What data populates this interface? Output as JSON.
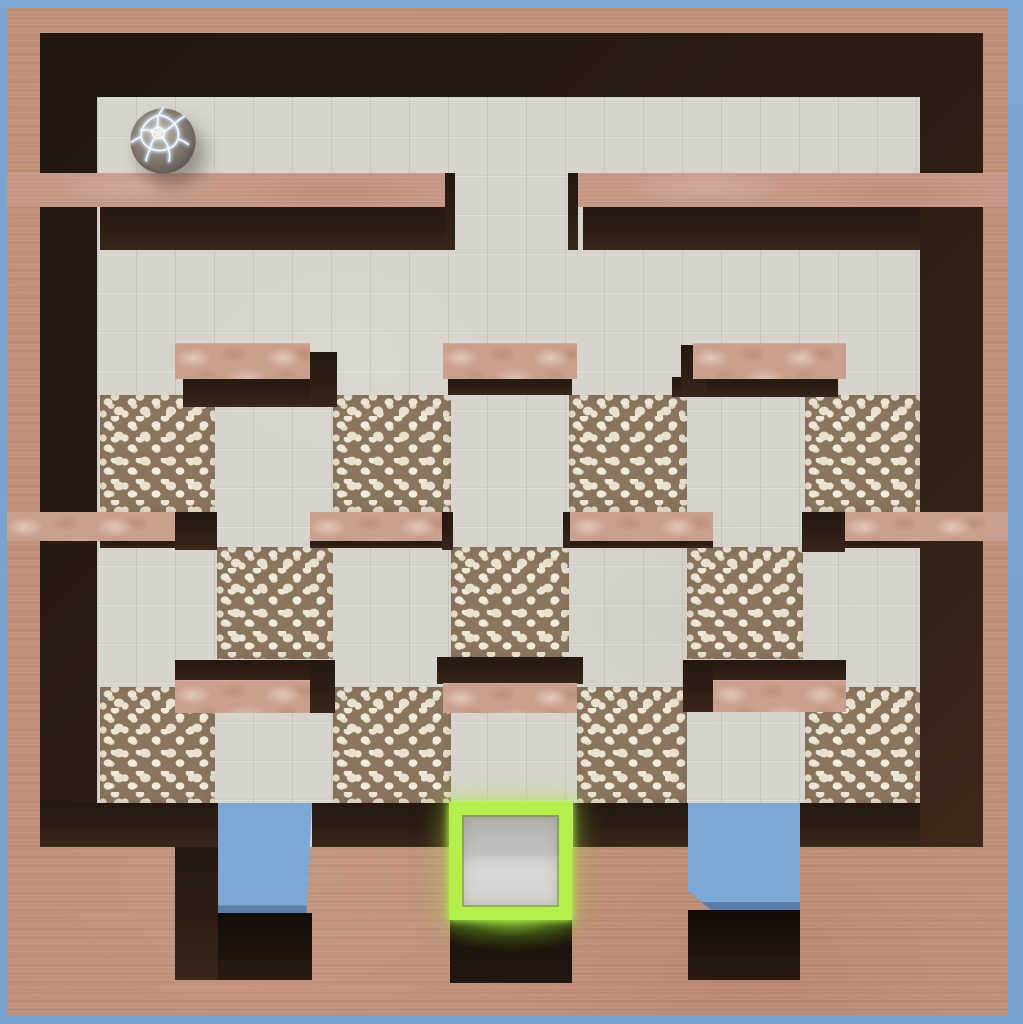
{
  "title": "marble-maze-level",
  "colors": {
    "sky": "#7ba8d3",
    "terracotta": "#c09078",
    "wall_top": "#c69685",
    "dark_wall": "#2a1c14",
    "floor_tile": "#d7d4cd",
    "pebble_ground": "#8a765f",
    "pebble_stone": "#f2ecdd",
    "marble_pink": "#cb9f8d",
    "goal_green": "#b4ef4b",
    "pit_blue": "#7ba8d4",
    "ball_seam": "#eaf3ff"
  },
  "game": {
    "ball": {
      "cx": 163,
      "cy": 141,
      "r": 34
    },
    "goal": {
      "x": 449,
      "y": 802,
      "w": 123,
      "h": 118
    },
    "pits": [
      {
        "x": 218,
        "y": 803,
        "w": 94,
        "h": 114
      },
      {
        "x": 688,
        "y": 803,
        "w": 112,
        "h": 110
      }
    ]
  },
  "scene": {
    "width": 1023,
    "height": 1024,
    "boxes": [
      {
        "name": "sky-background",
        "cls": "sky",
        "x": 0,
        "y": 0,
        "w": 1023,
        "h": 1024
      },
      {
        "name": "outer-wall-frame",
        "cls": "terr",
        "x": 7,
        "y": 8,
        "w": 1001,
        "h": 1007
      },
      {
        "name": "inner-wall-shadow",
        "cls": "dark",
        "x": 40,
        "y": 33,
        "w": 943,
        "h": 948
      },
      {
        "name": "tiled-floor",
        "cls": "tile",
        "x": 97,
        "y": 97,
        "w": 823,
        "h": 750
      },
      {
        "name": "pebble-patch",
        "cls": "pebble",
        "x": 100,
        "y": 395,
        "w": 115,
        "h": 117
      },
      {
        "name": "pebble-patch",
        "cls": "pebble",
        "x": 333,
        "y": 395,
        "w": 118,
        "h": 117
      },
      {
        "name": "pebble-patch",
        "cls": "pebble",
        "x": 569,
        "y": 395,
        "w": 118,
        "h": 117
      },
      {
        "name": "pebble-patch",
        "cls": "pebble",
        "x": 805,
        "y": 395,
        "w": 115,
        "h": 117
      },
      {
        "name": "pebble-patch",
        "cls": "pebble",
        "x": 217,
        "y": 547,
        "w": 116,
        "h": 112
      },
      {
        "name": "pebble-patch",
        "cls": "pebble",
        "x": 451,
        "y": 547,
        "w": 118,
        "h": 112
      },
      {
        "name": "pebble-patch",
        "cls": "pebble",
        "x": 687,
        "y": 547,
        "w": 116,
        "h": 112
      },
      {
        "name": "pebble-patch",
        "cls": "pebble",
        "x": 100,
        "y": 687,
        "w": 115,
        "h": 116
      },
      {
        "name": "pebble-patch",
        "cls": "pebble",
        "x": 333,
        "y": 687,
        "w": 118,
        "h": 116
      },
      {
        "name": "pebble-patch",
        "cls": "pebble",
        "x": 577,
        "y": 687,
        "w": 110,
        "h": 116
      },
      {
        "name": "pebble-patch",
        "cls": "pebble",
        "x": 805,
        "y": 687,
        "w": 115,
        "h": 116
      },
      {
        "name": "wall-row1-left-face",
        "cls": "darkface",
        "x": 100,
        "y": 205,
        "w": 352,
        "h": 45
      },
      {
        "name": "wall-row1-right-face",
        "cls": "darkface",
        "x": 583,
        "y": 205,
        "w": 337,
        "h": 45
      },
      {
        "name": "wall-row1-left-endcap",
        "cls": "darkface",
        "x": 445,
        "y": 173,
        "w": 10,
        "h": 77
      },
      {
        "name": "wall-row1-right-endcap",
        "cls": "darkface",
        "x": 568,
        "y": 173,
        "w": 10,
        "h": 77
      },
      {
        "name": "wall-row1-left-top",
        "cls": "walltop",
        "x": 7,
        "y": 173,
        "w": 438,
        "h": 34
      },
      {
        "name": "wall-row1-right-top",
        "cls": "walltop",
        "x": 578,
        "y": 173,
        "w": 430,
        "h": 34
      },
      {
        "name": "midwall-a-face",
        "cls": "darkface",
        "x": 100,
        "y": 539,
        "w": 75,
        "h": 9
      },
      {
        "name": "midwall-b-face",
        "cls": "darkface",
        "x": 310,
        "y": 539,
        "w": 132,
        "h": 9
      },
      {
        "name": "midwall-c-face",
        "cls": "darkface",
        "x": 570,
        "y": 539,
        "w": 143,
        "h": 9
      },
      {
        "name": "midwall-d-face",
        "cls": "darkface",
        "x": 845,
        "y": 539,
        "w": 75,
        "h": 9
      },
      {
        "name": "midwall-a-endcap",
        "cls": "darkface",
        "x": 175,
        "y": 512,
        "w": 42,
        "h": 38
      },
      {
        "name": "midwall-b-endcap",
        "cls": "darkface",
        "x": 442,
        "y": 512,
        "w": 11,
        "h": 38
      },
      {
        "name": "midwall-c-endcap",
        "cls": "darkface",
        "x": 563,
        "y": 512,
        "w": 7,
        "h": 36
      },
      {
        "name": "midwall-d-endcap",
        "cls": "darkface",
        "x": 802,
        "y": 512,
        "w": 43,
        "h": 40
      },
      {
        "name": "midwall-a-top",
        "cls": "midwall",
        "x": 7,
        "y": 512,
        "w": 168,
        "h": 29
      },
      {
        "name": "midwall-b-top",
        "cls": "midwall",
        "x": 310,
        "y": 512,
        "w": 132,
        "h": 29
      },
      {
        "name": "midwall-c-top",
        "cls": "midwall",
        "x": 570,
        "y": 512,
        "w": 143,
        "h": 29
      },
      {
        "name": "midwall-d-top",
        "cls": "midwall",
        "x": 845,
        "y": 512,
        "w": 163,
        "h": 29
      },
      {
        "name": "block-upper-left-face-s",
        "cls": "darkface",
        "x": 183,
        "y": 377,
        "w": 152,
        "h": 30
      },
      {
        "name": "block-upper-left-face-e",
        "cls": "darkface",
        "x": 310,
        "y": 352,
        "w": 27,
        "h": 55
      },
      {
        "name": "block-upper-left-top",
        "cls": "blocktop",
        "x": 175,
        "y": 343,
        "w": 135,
        "h": 36
      },
      {
        "name": "block-upper-center-face-s",
        "cls": "darkface",
        "x": 448,
        "y": 377,
        "w": 124,
        "h": 18
      },
      {
        "name": "block-upper-center-top",
        "cls": "blocktop",
        "x": 443,
        "y": 343,
        "w": 134,
        "h": 36
      },
      {
        "name": "block-upper-right-face-s",
        "cls": "darkface",
        "x": 672,
        "y": 377,
        "w": 166,
        "h": 20
      },
      {
        "name": "block-upper-right-face-w",
        "cls": "darkface",
        "x": 681,
        "y": 345,
        "w": 26,
        "h": 52
      },
      {
        "name": "block-upper-right-top",
        "cls": "blocktop",
        "x": 693,
        "y": 343,
        "w": 153,
        "h": 36
      },
      {
        "name": "block-lower-left-face-n",
        "cls": "darkface",
        "x": 175,
        "y": 660,
        "w": 160,
        "h": 23
      },
      {
        "name": "block-lower-left-face-e",
        "cls": "darkface",
        "x": 310,
        "y": 660,
        "w": 25,
        "h": 53
      },
      {
        "name": "block-lower-left-top",
        "cls": "blocktop",
        "x": 175,
        "y": 680,
        "w": 135,
        "h": 33
      },
      {
        "name": "block-lower-center-face-n",
        "cls": "darkface",
        "x": 437,
        "y": 657,
        "w": 146,
        "h": 27
      },
      {
        "name": "block-lower-center-top",
        "cls": "blocktop",
        "x": 443,
        "y": 683,
        "w": 134,
        "h": 30
      },
      {
        "name": "block-lower-right-face-n",
        "cls": "darkface",
        "x": 695,
        "y": 660,
        "w": 151,
        "h": 23
      },
      {
        "name": "block-lower-right-face-w",
        "cls": "darkface",
        "x": 683,
        "y": 660,
        "w": 30,
        "h": 52
      },
      {
        "name": "block-lower-right-top",
        "cls": "blocktop",
        "x": 713,
        "y": 680,
        "w": 133,
        "h": 32
      },
      {
        "name": "bottom-block-face-n",
        "cls": "darkface",
        "x": 40,
        "y": 803,
        "w": 178,
        "h": 44
      },
      {
        "name": "bottom-block-face-n",
        "cls": "darkface",
        "x": 312,
        "y": 803,
        "w": 137,
        "h": 44
      },
      {
        "name": "bottom-block-face-n",
        "cls": "darkface",
        "x": 573,
        "y": 803,
        "w": 115,
        "h": 44
      },
      {
        "name": "bottom-block-face-n",
        "cls": "darkface",
        "x": 846,
        "y": 803,
        "w": 74,
        "h": 44
      },
      {
        "name": "bottom-block-face-w",
        "cls": "darkface",
        "x": 800,
        "y": 803,
        "w": 46,
        "h": 44
      },
      {
        "name": "bottom-wall-band",
        "cls": "terr",
        "x": 7,
        "y": 847,
        "w": 1001,
        "h": 168
      },
      {
        "name": "bottom-left-block-face-e",
        "cls": "darkface",
        "x": 175,
        "y": 847,
        "w": 43,
        "h": 133
      },
      {
        "name": "pit-opening-left",
        "cls": "pit",
        "x": 218,
        "y": 803,
        "w": 94,
        "h": 114,
        "clip": "polygon(0 0,100% 0,94% 100%,0 100%)"
      },
      {
        "name": "pit-opening-right",
        "cls": "pit",
        "x": 688,
        "y": 803,
        "w": 112,
        "h": 110,
        "clip": "polygon(0 0,100% 0,100% 100%,24% 100%,0 80%)"
      },
      {
        "name": "pit-corridor-left",
        "cls": "corridor",
        "x": 218,
        "y": 913,
        "w": 94,
        "h": 67
      },
      {
        "name": "pit-corridor-right",
        "cls": "corridor",
        "x": 688,
        "y": 910,
        "w": 112,
        "h": 70
      },
      {
        "name": "goal-glow-corridor",
        "cls": "goal-glow",
        "x": 450,
        "y": 915,
        "w": 122,
        "h": 68
      },
      {
        "name": "goal-exit",
        "cls": "goal-frame",
        "x": 449,
        "y": 802,
        "w": 123,
        "h": 118
      },
      {
        "name": "player-ball",
        "cls": "ball",
        "x": 129,
        "y": 107,
        "w": 68,
        "h": 68,
        "interactable": true
      }
    ]
  }
}
